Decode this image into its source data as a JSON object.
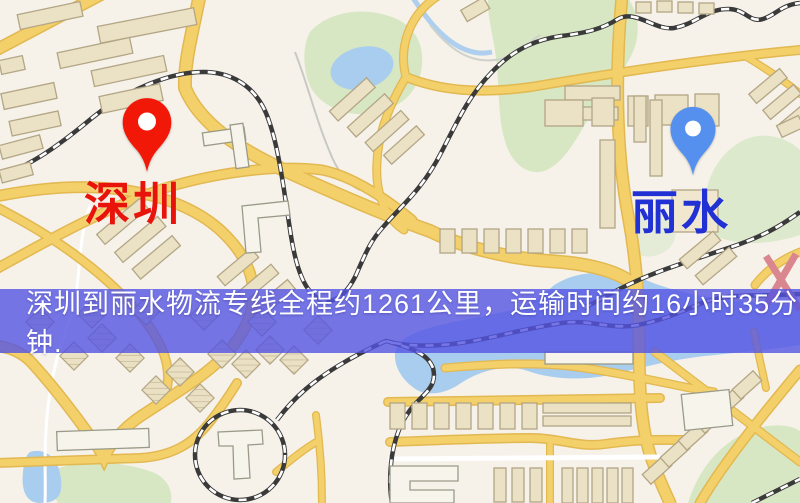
{
  "banner": {
    "text": "深圳到丽水物流专线全程约1261公里，运输时间约16小时35分钟.",
    "background_rgba": "rgba(84,84,228,0.80)",
    "text_color": "#ffffff"
  },
  "markers": {
    "origin": {
      "label": "深圳",
      "pin_color": "#f21808",
      "label_color": "#e8140c"
    },
    "destination": {
      "label": "丽水",
      "pin_color": "#5590ee",
      "label_color": "#2231d4"
    }
  },
  "map_colors": {
    "base": "#f6f2ea",
    "park": "#d7e7c3",
    "water": "#a9cdee",
    "road": "#f4d06a",
    "road_casing": "#e2b851",
    "building": "#ebe1c5",
    "railway": "#3a3a3a"
  }
}
